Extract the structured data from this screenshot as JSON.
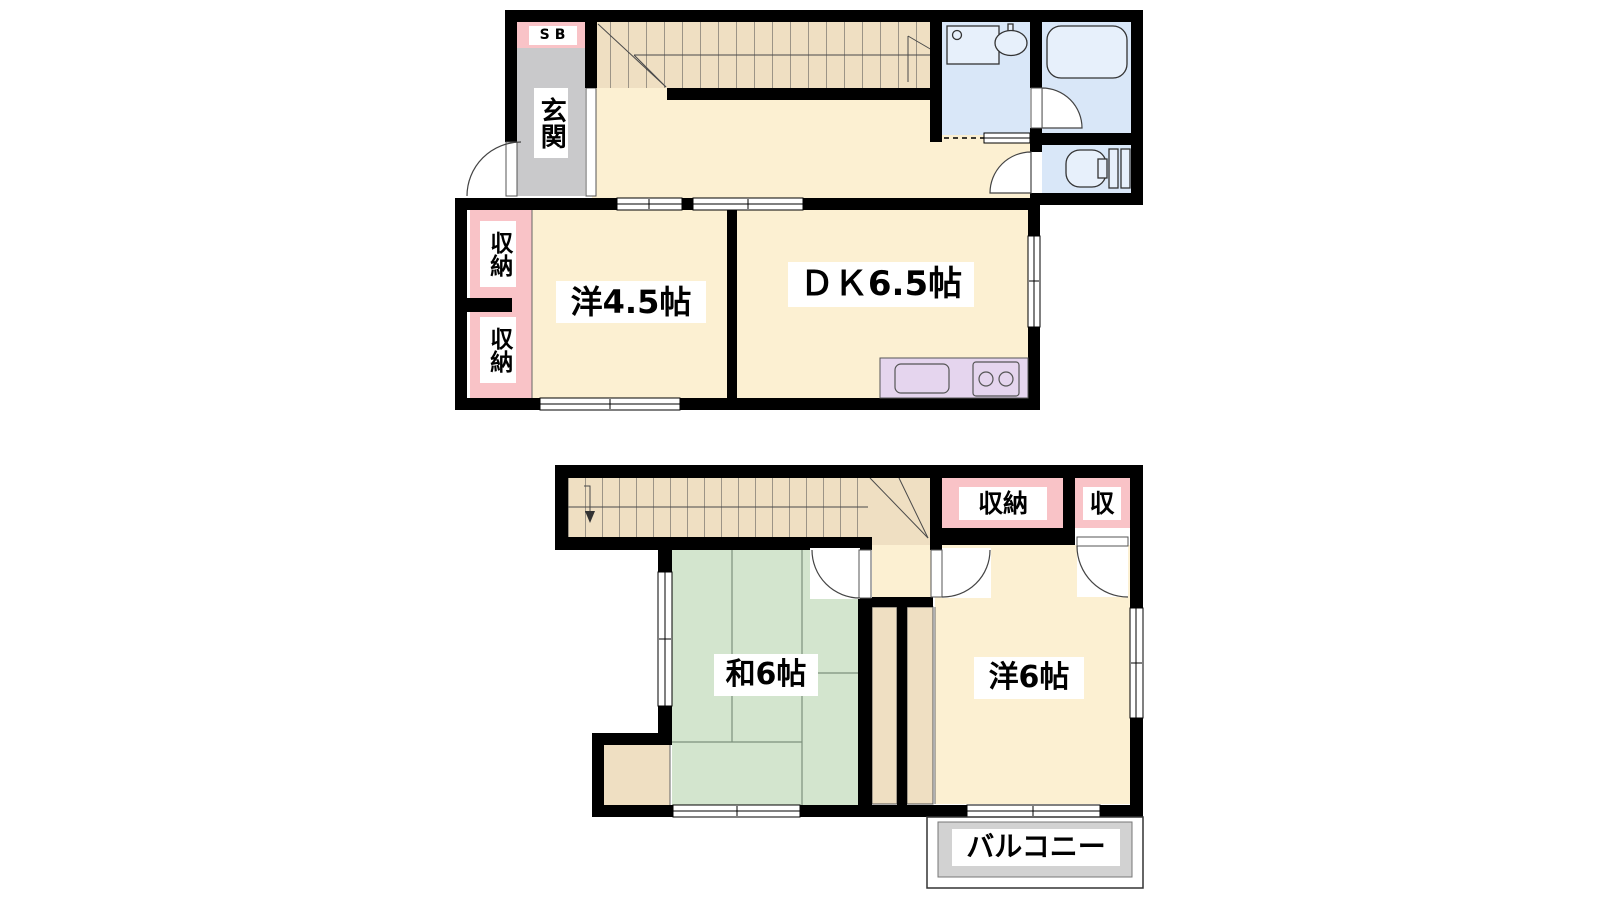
{
  "colors": {
    "wall": "#000000",
    "room": "#FCF0D2",
    "stairs": "#EFDFC2",
    "tatami": "#D3E5CE",
    "tatami-line": "#7d917d",
    "storage-pink": "#F9C3C7",
    "entrance-gray": "#C9C9CB",
    "water-blue": "#D9E7F8",
    "fixture-blue": "#E7F0FB",
    "kitchen-lavender": "#E5D5EE",
    "balcony-gray": "#D2D2D2",
    "line": "#333333"
  },
  "floor1": {
    "shoe_box": "SB",
    "entrance": "玄関",
    "storage_upper": "収納",
    "storage_lower": "収納",
    "western_room": "洋4.5帖",
    "dining_kitchen": "ＤＫ6.5帖"
  },
  "floor2": {
    "storage": "収納",
    "storage_small": "収",
    "japanese_room": "和6帖",
    "western_room": "洋6帖",
    "balcony": "バルコニー"
  }
}
